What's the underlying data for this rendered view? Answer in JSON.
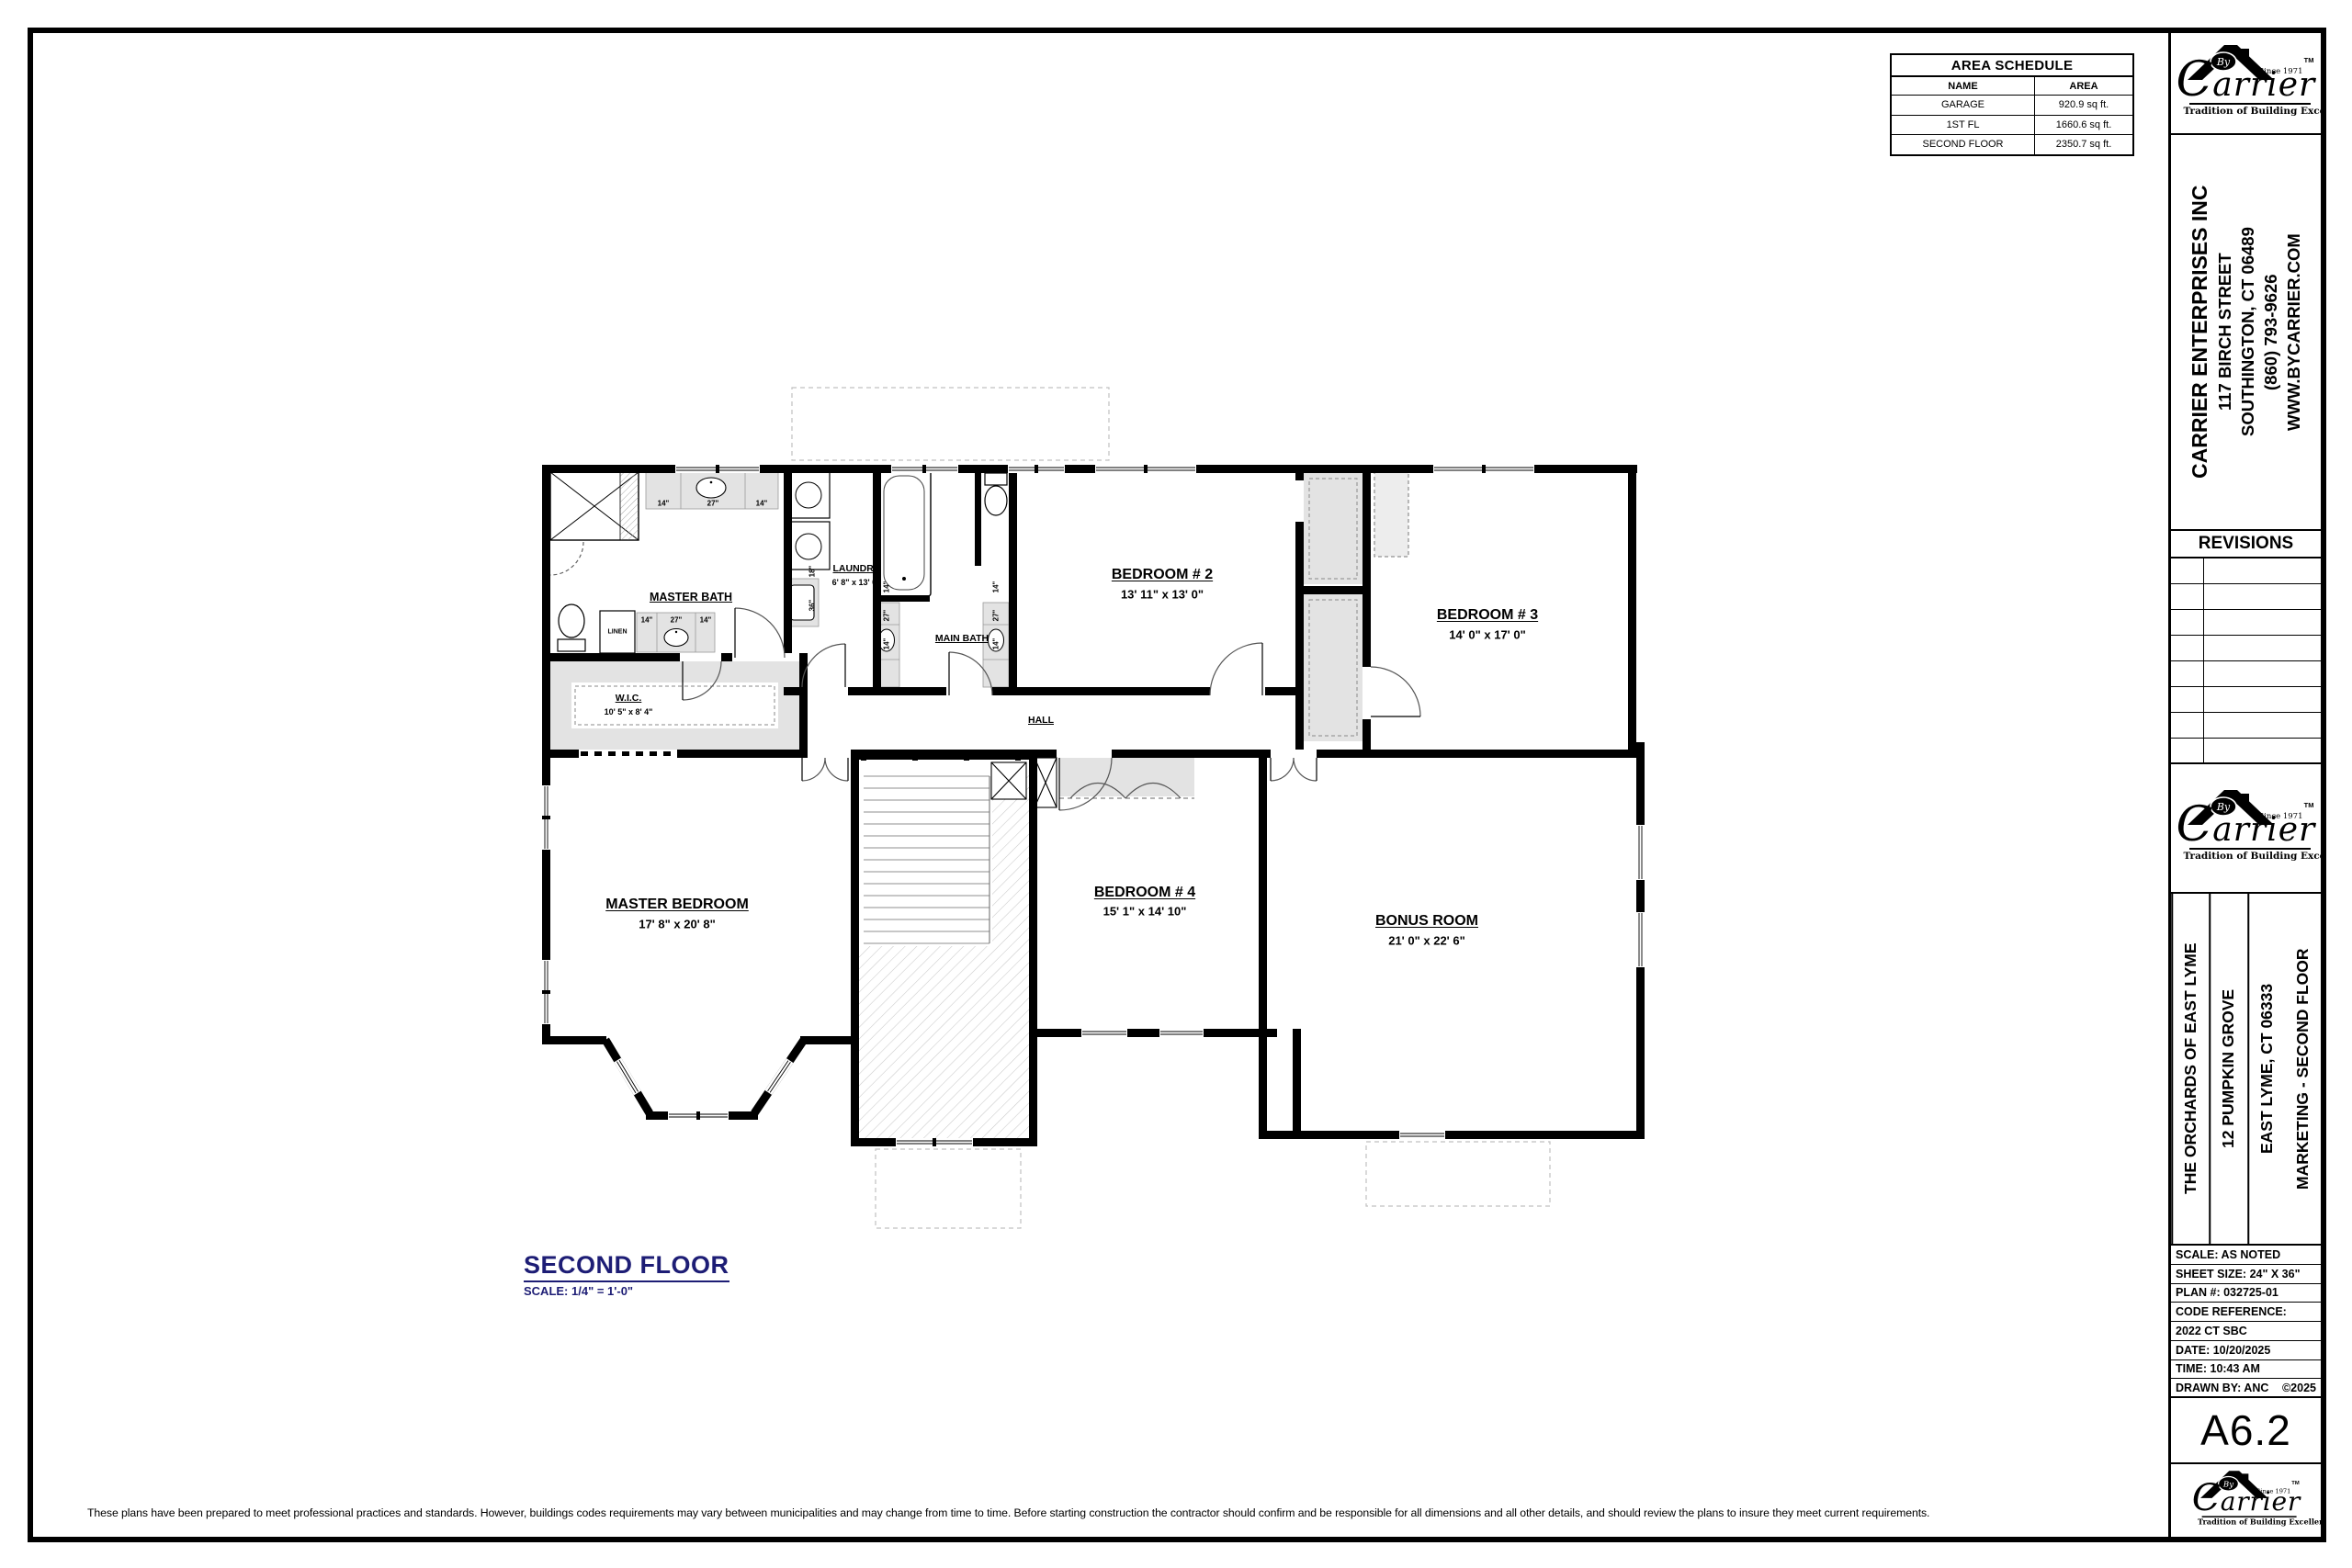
{
  "page": {
    "background": "#ffffff",
    "accent_navy": "#1d1d75",
    "wall_color": "#000000",
    "fixture_gray": "#e3e3e3"
  },
  "area_schedule": {
    "title": "AREA SCHEDULE",
    "headers": {
      "name": "NAME",
      "area": "AREA"
    },
    "rows": [
      {
        "name": "GARAGE",
        "area": "920.9 sq ft."
      },
      {
        "name": "1ST FL",
        "area": "1660.6 sq ft."
      },
      {
        "name": "SECOND FLOOR",
        "area": "2350.7 sq ft."
      }
    ]
  },
  "brand": {
    "by": "By",
    "initial": "C",
    "name": "arrier",
    "since": "Since 1971",
    "tm": "TM",
    "tagline": "Tradition of Building Excellence"
  },
  "title_block": {
    "company": {
      "name": "CARRIER ENTERPRISES INC",
      "address": "117 BIRCH STREET",
      "city_state_zip": "SOUTHINGTON, CT 06489",
      "phone": "(860) 793-9626",
      "website": "WWW.BYCARRIER.COM"
    },
    "revisions_label": "REVISIONS",
    "project": {
      "development": "THE ORCHARDS OF EAST LYME",
      "address": "12 PUMPKIN GROVE",
      "city_state_zip": "EAST LYME, CT 06333",
      "sheet_title": "MARKETING - SECOND FLOOR"
    },
    "info": {
      "scale": "SCALE: AS NOTED",
      "sheet_size": "SHEET SIZE: 24\" X 36\"",
      "plan_number": "PLAN #: 032725-01",
      "code_reference": "CODE REFERENCE:",
      "code": "2022 CT SBC",
      "date": "DATE: 10/20/2025",
      "time": "TIME: 10:43 AM",
      "drawn_by": "DRAWN BY: ANC",
      "copyright": "©2025"
    },
    "sheet_number": "A6.2"
  },
  "plan_title": {
    "title": "SECOND FLOOR",
    "scale": "SCALE: 1/4\" = 1'-0\""
  },
  "disclaimer": "These plans have been prepared to meet professional practices and standards. However, buildings codes requirements may vary between municipalities and may change from time to time. Before starting construction the contractor should confirm and be responsible for all dimensions and all other details, and should review the plans to insure they meet current requirements.",
  "plan": {
    "rooms": {
      "master_bath": {
        "label": "MASTER BATH"
      },
      "linen": {
        "label": "LINEN"
      },
      "wic": {
        "label": "W.I.C.",
        "dims": "10' 5\" x 8' 4\""
      },
      "laundry": {
        "label": "LAUNDRY",
        "dims": "6' 8\" x 13' 0\""
      },
      "main_bath": {
        "label": "MAIN BATH"
      },
      "bedroom2": {
        "label": "BEDROOM # 2",
        "dims": "13' 11\" x 13' 0\""
      },
      "bedroom3": {
        "label": "BEDROOM # 3",
        "dims": "14' 0\" x 17' 0\""
      },
      "bedroom4": {
        "label": "BEDROOM # 4",
        "dims": "15' 1\" x 14' 10\""
      },
      "bonus_room": {
        "label": "BONUS ROOM",
        "dims": "21' 0\" x 22' 6\""
      },
      "master_bedroom": {
        "label": "MASTER BEDROOM",
        "dims": "17' 8\" x 20' 8\""
      },
      "hall": {
        "label": "HALL"
      }
    },
    "fixture_labels": {
      "w14": "14\"",
      "w27": "27\"",
      "w18": "18\"",
      "w36": "36\""
    }
  }
}
